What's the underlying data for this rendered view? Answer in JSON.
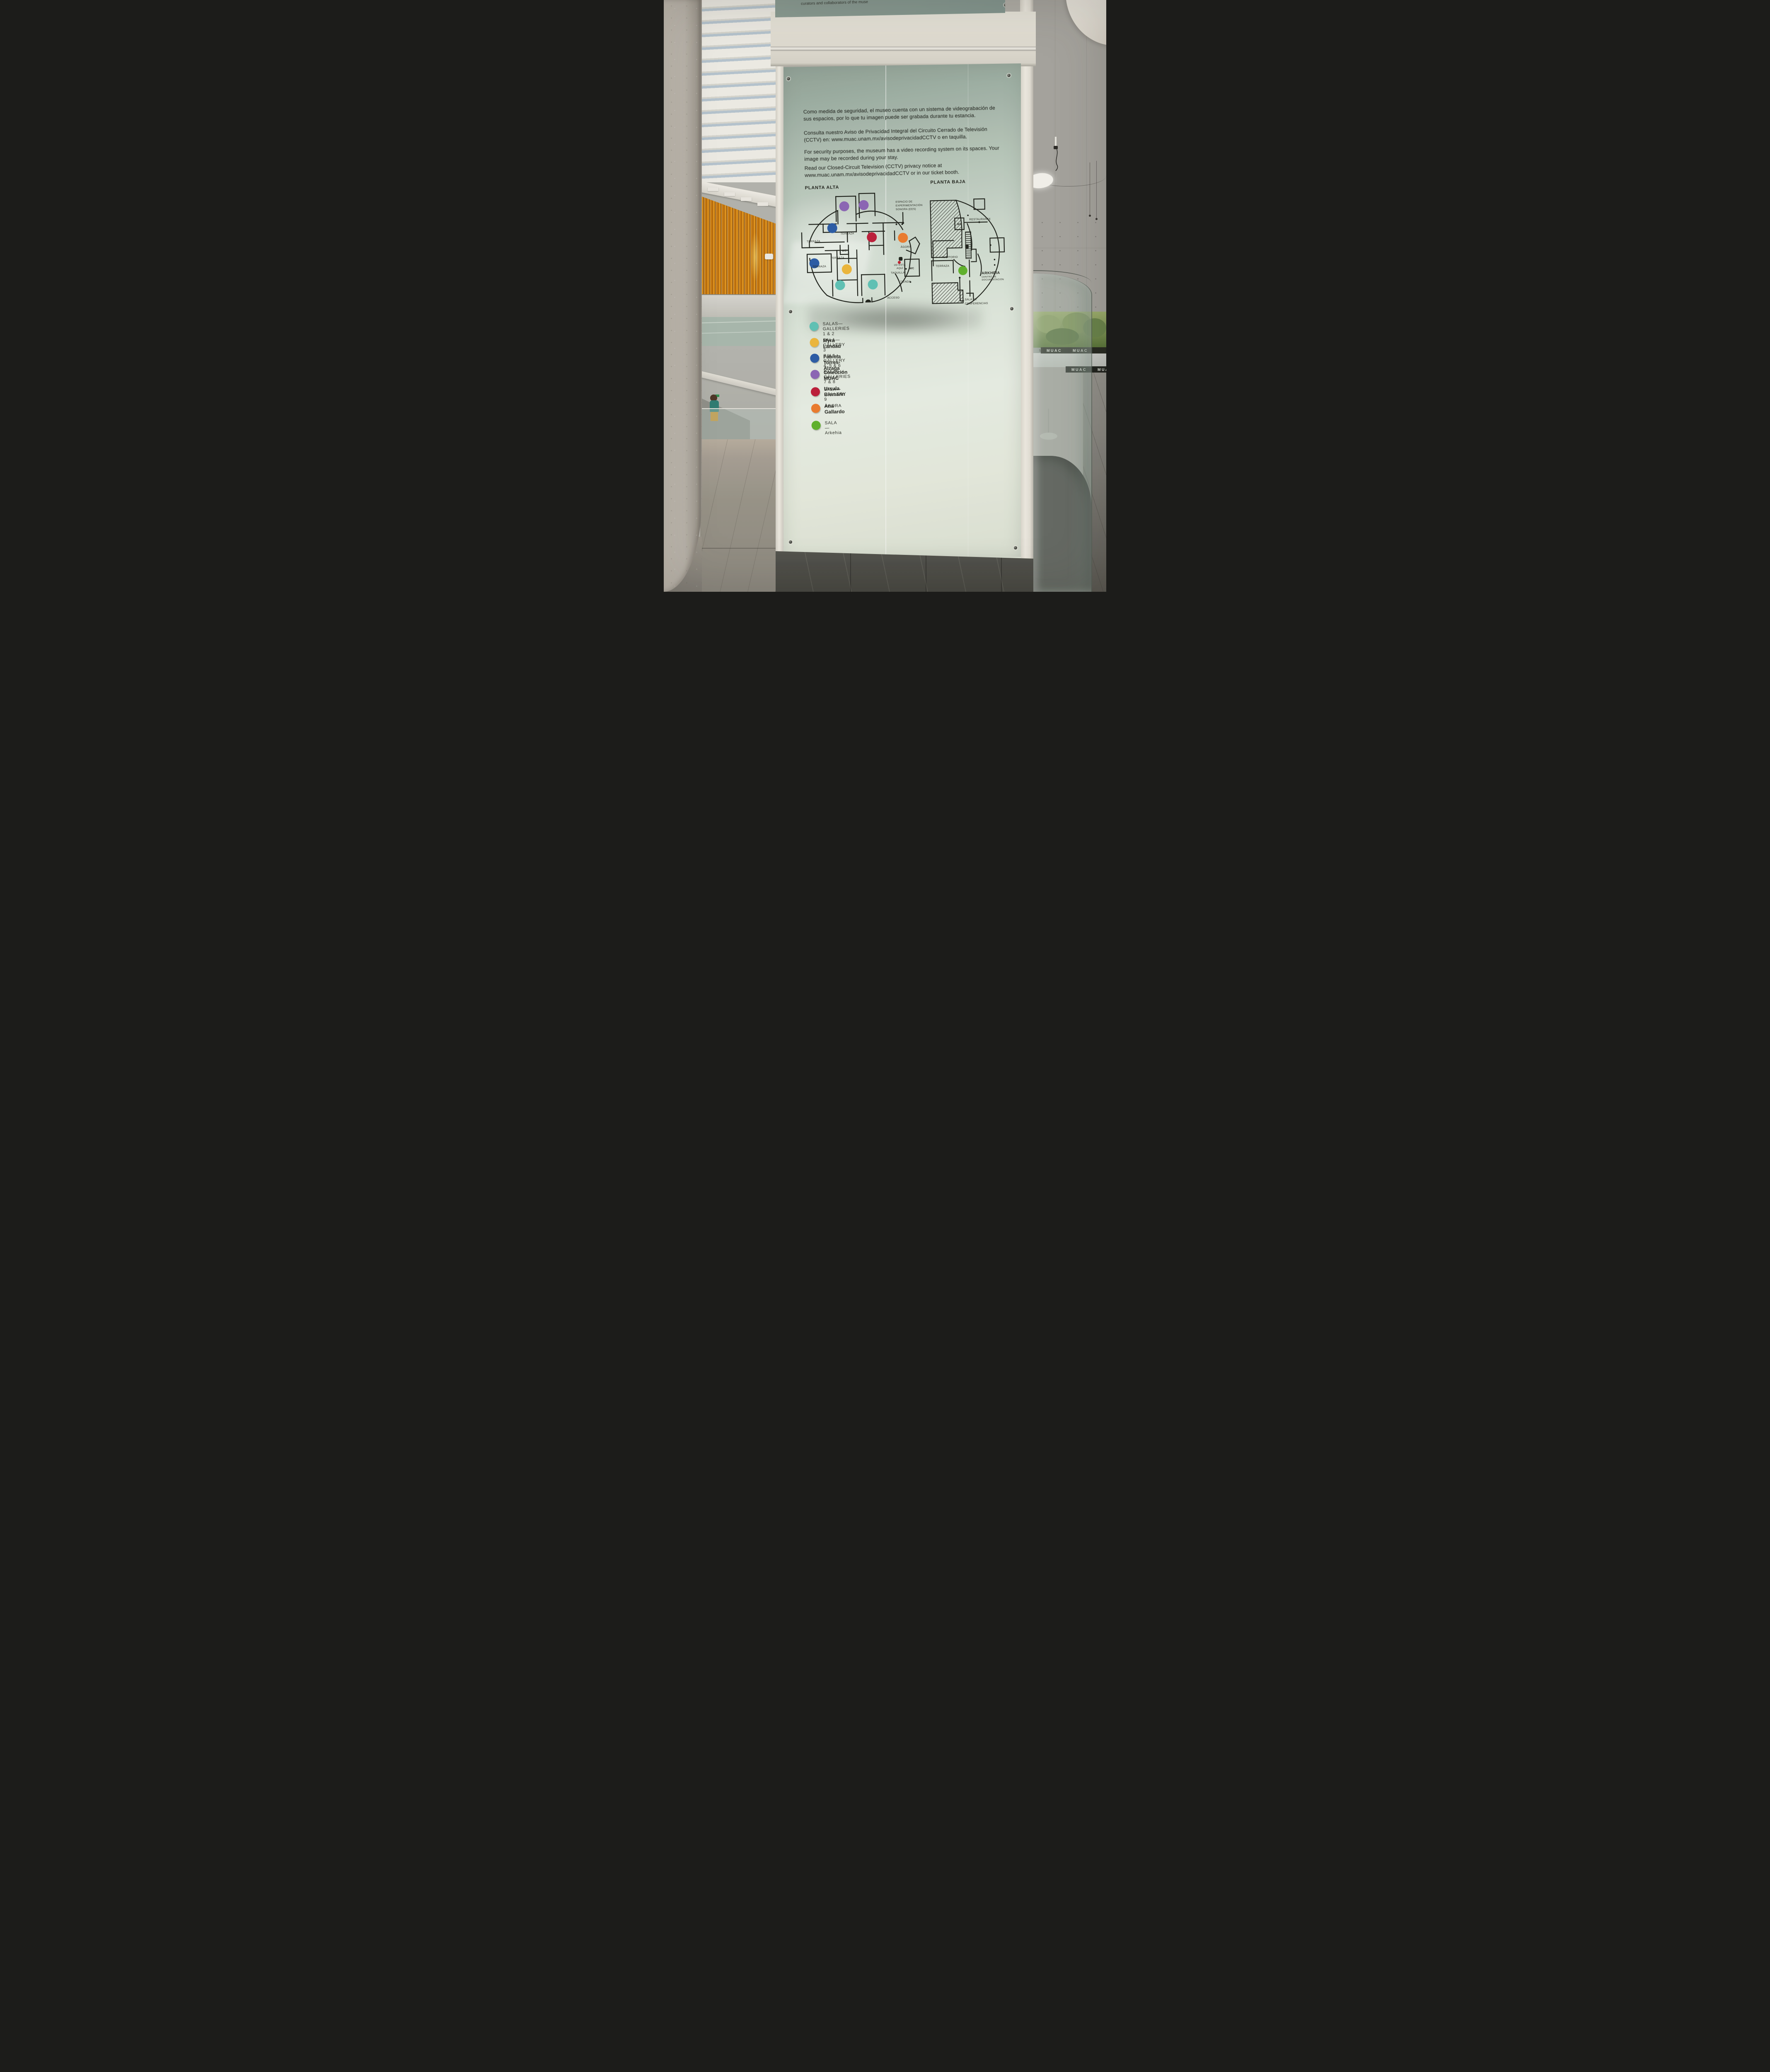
{
  "scene": {
    "muac_wordmark": "MUAC",
    "top_panel_fragment": "curators and collaborators of the muse"
  },
  "panel": {
    "paragraphs": {
      "es1": "Como medida de seguridad, el museo cuenta con un sistema de videograbación de sus espacios, por lo que tu imagen puede ser grabada durante tu estancia.",
      "es2": "Consulta nuestro Aviso de Privacidad Integral del Circuito Cerrado de Televisión (CCTV) en: www.muac.unam.mx/avisodeprivacidadCCTV o en taquilla.",
      "en1": "For security purposes, the museum has a video recording system on its spaces. Your image may be recorded during your stay.",
      "en2": "Read our Closed-Circuit Television (CCTV) privacy notice at www.muac.unam.mx/avisodeprivacidadCCTV or in our ticket booth."
    },
    "maps": {
      "alta": {
        "title": "PLANTA ALTA",
        "labels": {
          "terraza": "TERRAZA",
          "ees_lines": [
            "ESPACIO DE",
            "EXPERIMENTACIÓN",
            "SONORA (EES)"
          ],
          "agora": "ÁGORA",
          "you_are_here_lines": [
            "UD ESTÁ",
            "AQUÍ"
          ],
          "taquilla": "TAQUILLA",
          "tienda": "TIENDA",
          "acceso": "ACCESO",
          "wc": "WC"
        }
      },
      "baja": {
        "title": "PLANTA BAJA",
        "labels": {
          "restaurante": "RESTAURANTE",
          "auditorio": "AUDITORIO",
          "terraza": "TERRAZA",
          "arkheia_lines": [
            "ARKHEIA",
            "CENTRO DE",
            "DOCUMENTACIÓN"
          ],
          "conferencias_lines": [
            "SALA DE",
            "CONFERENCIAS"
          ],
          "wc": "WC"
        }
      },
      "you_are_here_color": "#C2202F"
    },
    "legend": [
      {
        "color": "#5FC4B8",
        "title": "SALAS—GALLERIES 1 & 2",
        "name": "Myra Landau"
      },
      {
        "color": "#EFB93C",
        "title": "SALA—GALLERY 3",
        "name": "Fabiola Torres-Alzaga"
      },
      {
        "color": "#2A5CA8",
        "title": "SALA—GALLERY 4, 5 & 6",
        "name": "Colección MUAC"
      },
      {
        "color": "#8C67B8",
        "title": "SALAS—GALLERIES 7 & 8",
        "name": "Ursula Biemann"
      },
      {
        "color": "#BE1E3B",
        "title": "SALA—GALLERY 9",
        "name": "Ana Gallardo"
      },
      {
        "color": "#EE7C2E",
        "title": "ÁGORA",
        "name": ""
      },
      {
        "color": "#5FB32C",
        "title": "SALA—Arkehia",
        "name": ""
      }
    ]
  }
}
